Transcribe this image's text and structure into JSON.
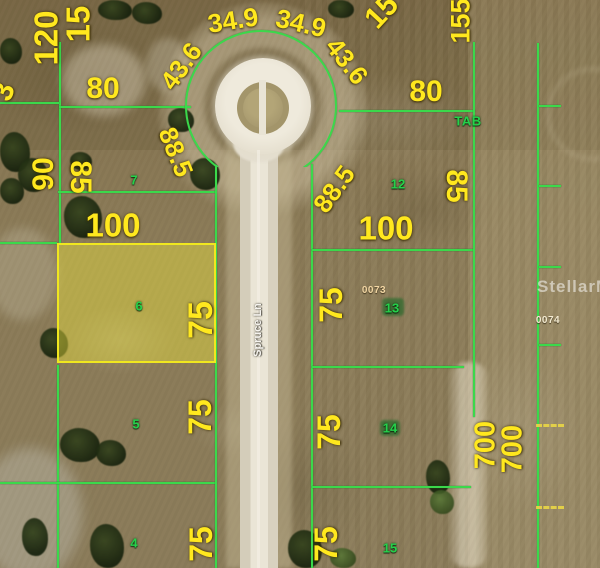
{
  "road": {
    "name": "Spruce Ln"
  },
  "watermark": "StellarMLS",
  "annotations": {
    "tab": "TAB",
    "parcel_left": "0073",
    "parcel_right": "0074"
  },
  "lot_numbers": {
    "lot7": "7",
    "lot12": "12",
    "lot6": "6",
    "lot13": "13",
    "lot5": "5",
    "lot14": "14",
    "lot4": "4",
    "lot15": "15"
  },
  "dimensions": {
    "edge_120": "120",
    "edge_150": "15",
    "edge_3": "3",
    "arc_349_left": "34.9",
    "arc_349_right": "34.9",
    "arc_436_left": "43.6",
    "arc_436_right": "43.6",
    "arc_885_left": "88.5",
    "arc_885_right": "88.5",
    "edge_15_diag": "15",
    "edge_155": "155",
    "width_80_left": "80",
    "width_80_right": "80",
    "side_90": "90",
    "side_85_left": "85",
    "side_85_right": "85",
    "width_100_left": "100",
    "width_100_right": "100",
    "depth_75_lot6": "75",
    "depth_75_lot13": "75",
    "depth_75_lot5": "75",
    "depth_75_lot14": "75",
    "depth_75_lot4": "75",
    "depth_75_lot15": "75",
    "side_700_a": "700",
    "side_700_b": "700"
  },
  "colors": {
    "plat_line": "#3bd84b",
    "dimension_label": "#ffe81e",
    "lot_number": "#25d14b",
    "highlight_fill": "rgba(233,224,62,0.45)",
    "highlight_border": "#f0e71f",
    "road": "#e6e0d0",
    "parcel_id_text": "#f3d7a4"
  }
}
